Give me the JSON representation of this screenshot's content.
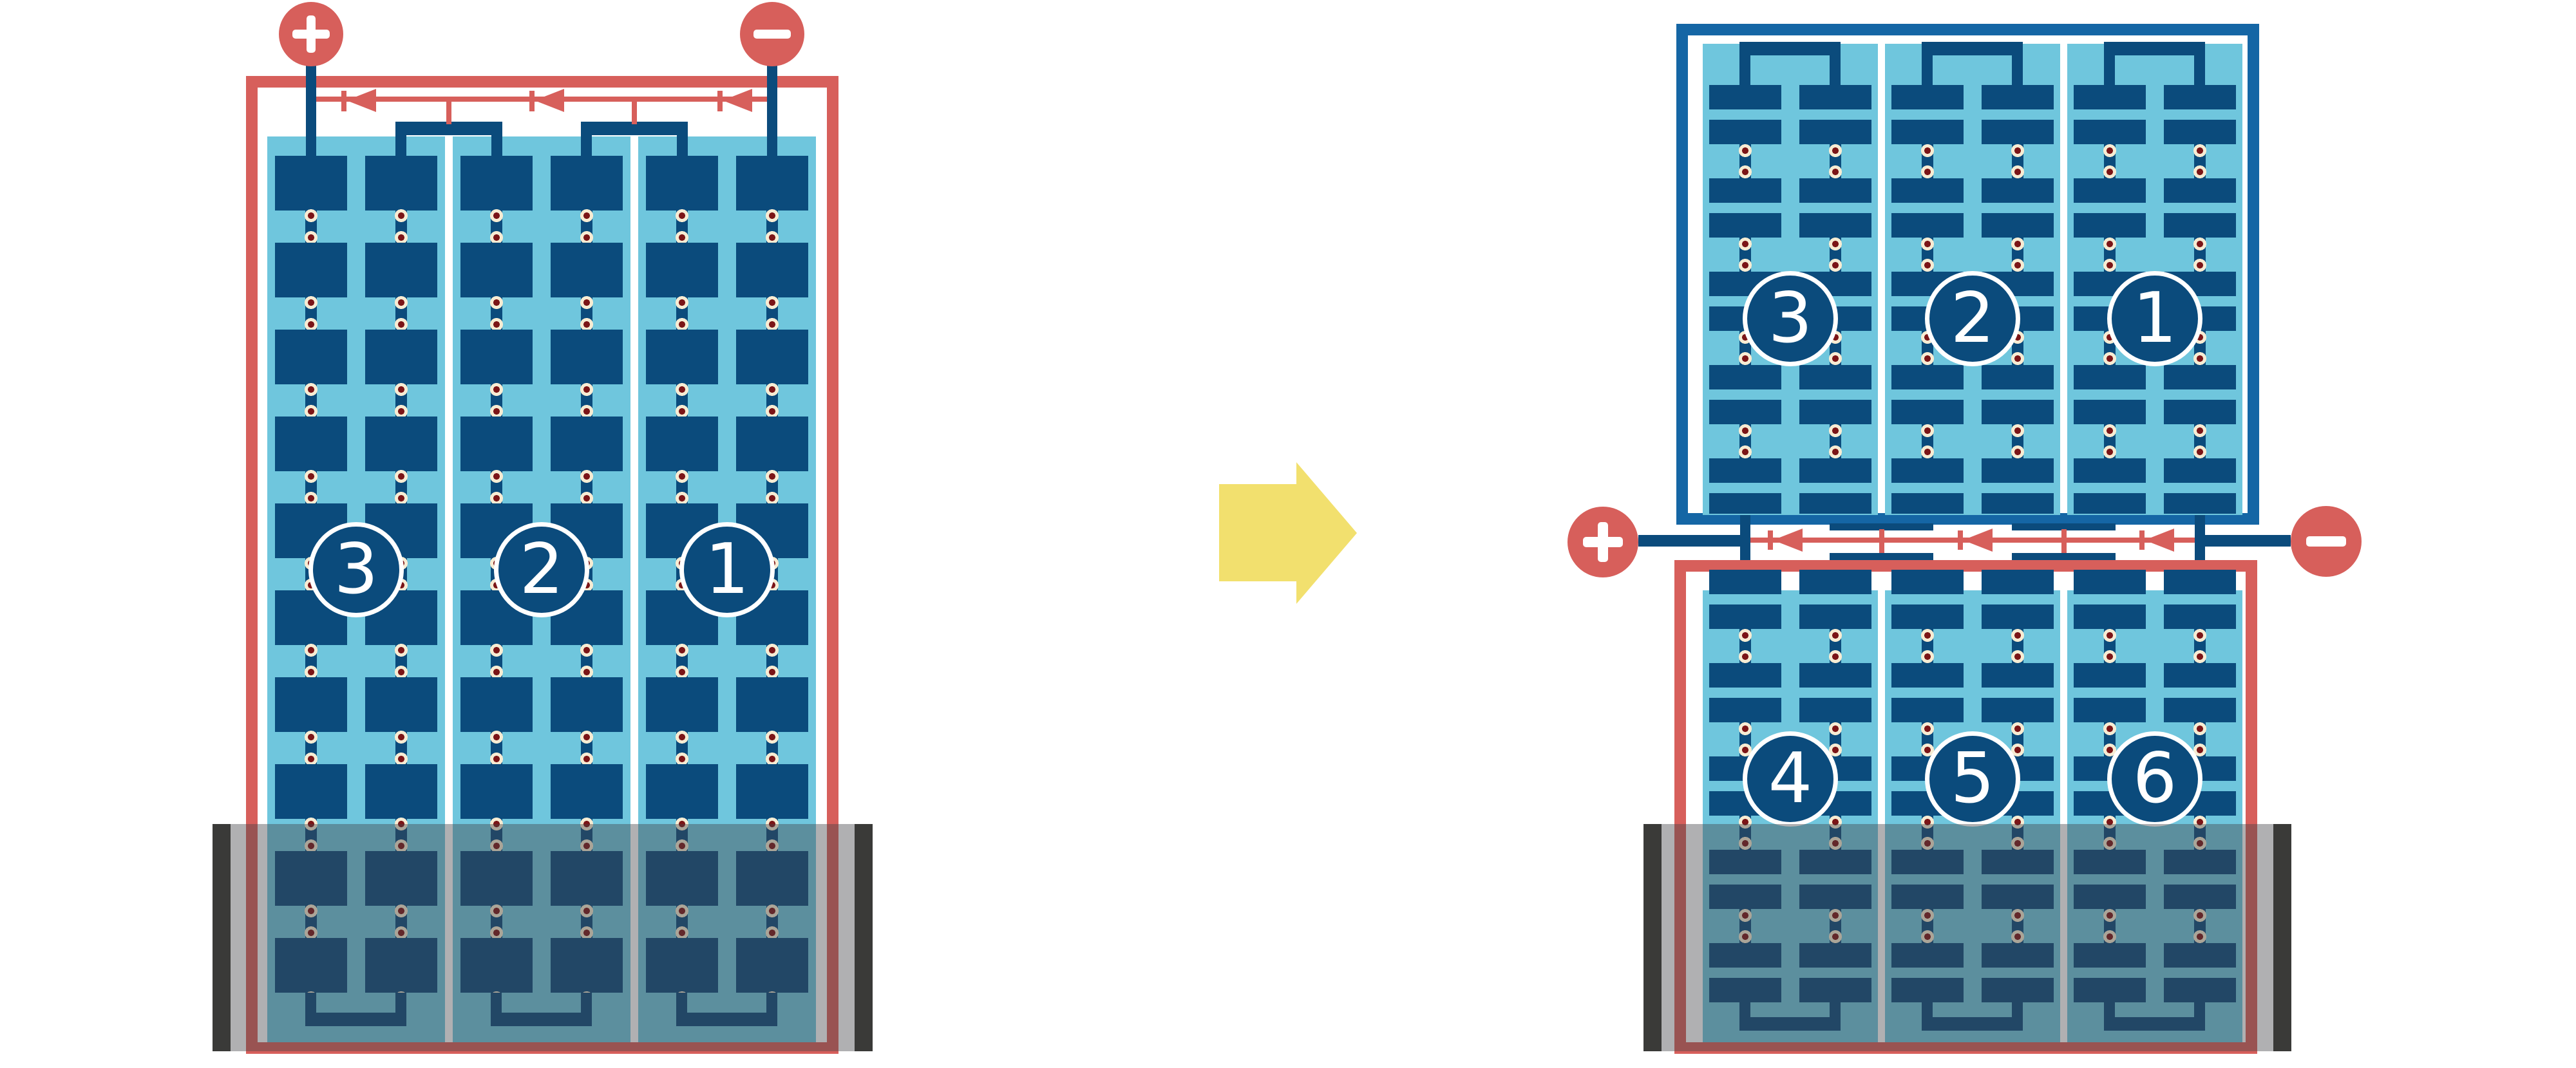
{
  "diagram": {
    "left_battery": {
      "cells": [
        "3",
        "2",
        "1"
      ],
      "positive_terminal": "+",
      "negative_terminal": "−"
    },
    "right_top_battery": {
      "cells": [
        "3",
        "2",
        "1"
      ]
    },
    "right_bottom_battery": {
      "cells": [
        "4",
        "5",
        "6"
      ]
    },
    "right_assembly_terminals": {
      "positive_terminal": "+",
      "negative_terminal": "−"
    },
    "icons": {
      "transform_arrow": "right-block-arrow",
      "current_flow": "left-pointing-arrowheads"
    },
    "colors": {
      "salmon_red": "#D75F5B",
      "plate_navy": "#0B4B7C",
      "case_blue": "#1566A5",
      "electrolyte_blue": "#6FC6DD",
      "bubble_cream": "#F7ECD3",
      "bubble_dark_red": "#7B1517",
      "transform_yellow": "#F2E06E",
      "clamp_black": "#3A3A38",
      "tray_overlay": "rgba(66,66,72,0.42)"
    }
  }
}
